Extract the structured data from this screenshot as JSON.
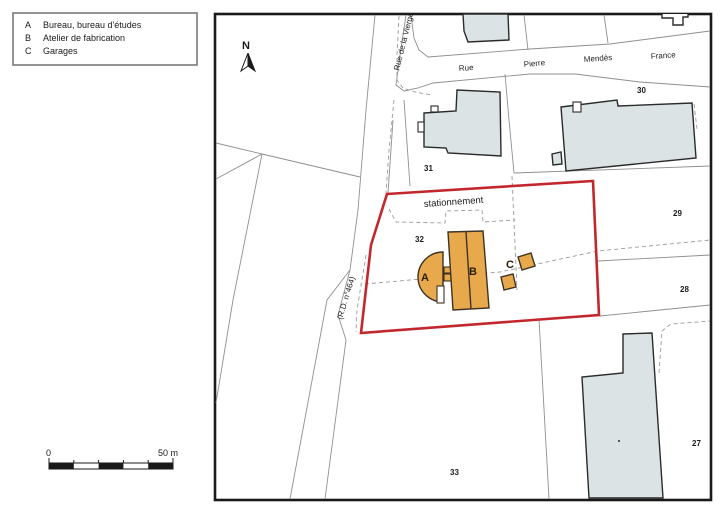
{
  "legend": {
    "items": [
      {
        "key": "A",
        "label": "Bureau, bureau d'études"
      },
      {
        "key": "B",
        "label": "Atelier de fabrication"
      },
      {
        "key": "C",
        "label": "Garages"
      }
    ]
  },
  "north_label": "N",
  "scale_bar": {
    "start_label": "0",
    "end_label": "50 m"
  },
  "map": {
    "street_labels": {
      "rue_de_la_vierge": "Rue de la Vierge",
      "rue": "Rue",
      "pierre": "Pierre",
      "mendes": "Mendès",
      "france": "France",
      "rd": "(R.D. n°464)"
    },
    "area_labels": {
      "stationnement": "stationnement"
    },
    "parcel_numbers": {
      "p27": "27",
      "p28": "28",
      "p29": "29",
      "p30": "30",
      "p31": "31",
      "p32": "32",
      "p33": "33"
    },
    "building_labels": {
      "a": "A",
      "b": "B",
      "c": "C"
    },
    "colors": {
      "site_outline_red": "#C3272E",
      "building_highlight_orange": "#E8A84C",
      "building_existing_gray": "#DCE3E5",
      "parcel_line_gray": "#8F8F8F",
      "frame_black": "#1A1A1A"
    }
  }
}
